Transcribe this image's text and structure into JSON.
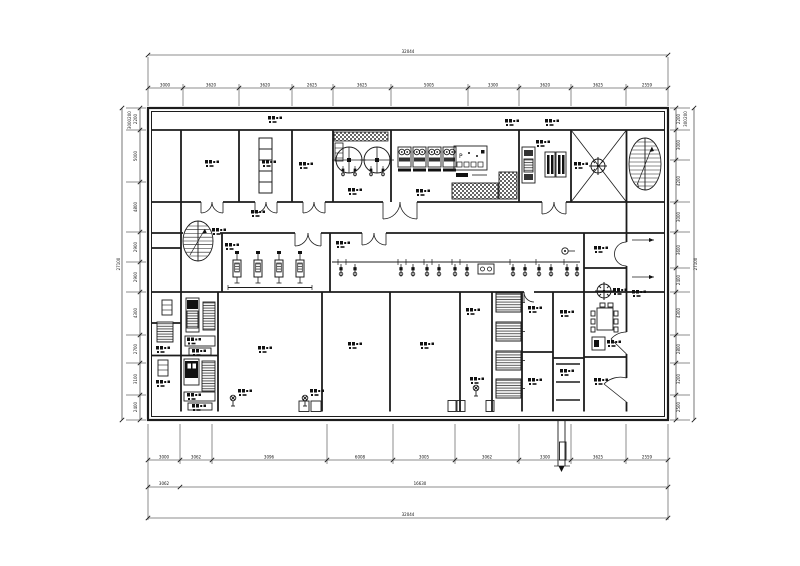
{
  "drawing": {
    "kind": "architectural-floor-plan",
    "ink_color": "#1c1c1c",
    "hatch_color": "#555555",
    "panel_label": "P",
    "stair_label": "1"
  },
  "dimensions": {
    "overall_top": "32044",
    "overall_bottom": "32044",
    "overall_left": "27100",
    "overall_right": "27100",
    "bottom_sub_left": "3062",
    "bottom_sub_right": "16630",
    "left_top": [
      "200",
      "3000"
    ],
    "right_top": [
      "200",
      "300"
    ],
    "top_chain": [
      "3000",
      "3620",
      "3620",
      "2625",
      "3625",
      "5005",
      "3300",
      "3620",
      "3625",
      "2559"
    ],
    "bottom_chain": [
      "3000",
      "3062",
      "3096",
      "6008",
      "3005",
      "3062",
      "3300",
      "3625",
      "2559"
    ],
    "left_chain": [
      "2200",
      "5000",
      "4800",
      "2900",
      "2900",
      "4300",
      "2700",
      "3100",
      "2400"
    ],
    "right_chain": [
      "2200",
      "3000",
      "4200",
      "3000",
      "3600",
      "2400",
      "4300",
      "2800",
      "3200",
      "2500"
    ]
  }
}
